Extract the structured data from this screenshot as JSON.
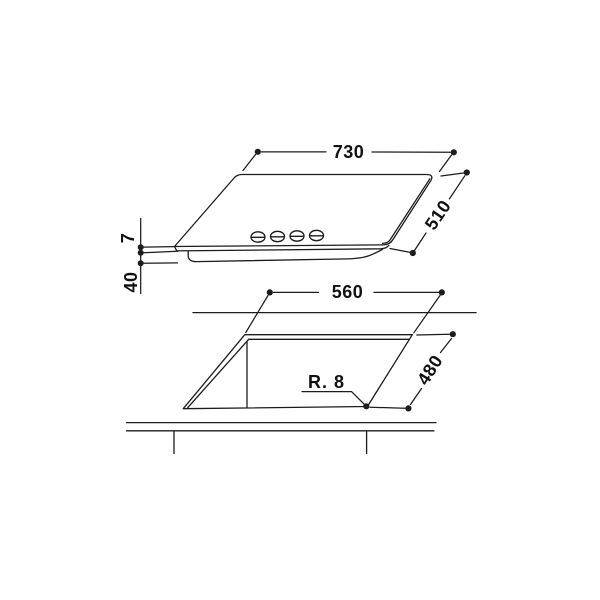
{
  "drawing": {
    "background": "#ffffff",
    "line_color": "#1c1c1c",
    "hob_view": {
      "width_mm": "730",
      "depth_mm": "510",
      "glass_height_mm": "7",
      "body_height_mm": "40",
      "knob_count": 4
    },
    "cutout_view": {
      "width_mm": "560",
      "depth_mm": "480",
      "corner_radius": "R. 8"
    }
  }
}
